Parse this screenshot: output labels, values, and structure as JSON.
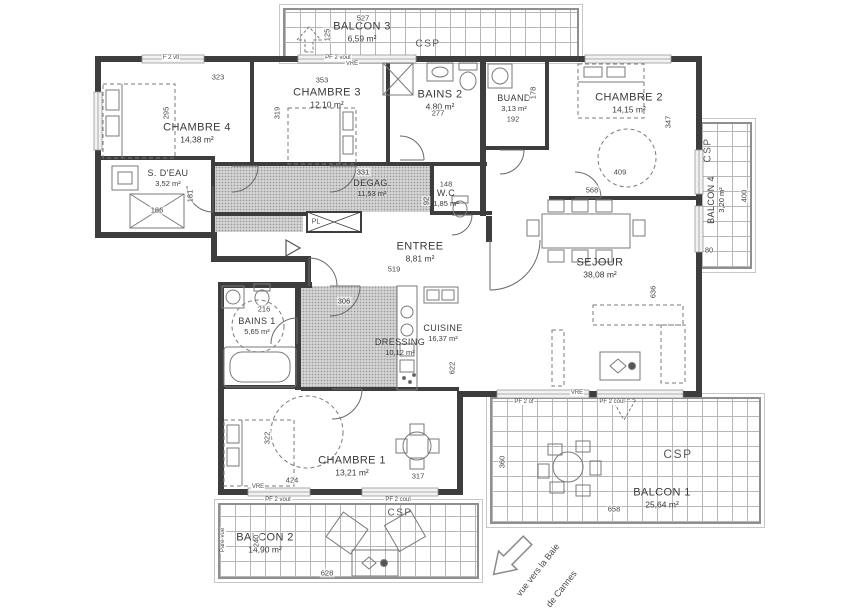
{
  "rooms": [
    {
      "name": "CHAMBRE 4",
      "area": "14,38 m²"
    },
    {
      "name": "CHAMBRE 3",
      "area": "12,10 m²"
    },
    {
      "name": "BAINS 2",
      "area": "4,80 m²"
    },
    {
      "name": "BUAND",
      "area": "3,13 m²"
    },
    {
      "name": "CHAMBRE 2",
      "area": "14,15 m²"
    },
    {
      "name": "S. D'EAU",
      "area": "3,52 m²"
    },
    {
      "name": "DEGAG.",
      "area": "11,53 m²"
    },
    {
      "name": "W.C",
      "area": "1,85 m²"
    },
    {
      "name": "ENTREE",
      "area": "8,81 m²"
    },
    {
      "name": "SEJOUR",
      "area": "38,08 m²"
    },
    {
      "name": "BAINS 1",
      "area": "5,65 m²"
    },
    {
      "name": "DRESSING",
      "area": "10,12 m²"
    },
    {
      "name": "CUISINE",
      "area": "16,37 m²"
    },
    {
      "name": "CHAMBRE 1",
      "area": "13,21 m²"
    },
    {
      "name": "BALCON 1",
      "area": "25,64 m²"
    },
    {
      "name": "BALCON 2",
      "area": "14,90 m²"
    },
    {
      "name": "BALCON 3",
      "area": "6,59 m²"
    },
    {
      "name": "BALCON 4",
      "area": "3,20 m²"
    }
  ],
  "dims": {
    "d527": "527",
    "d125": "125",
    "d323": "323",
    "d353": "353",
    "d295": "295",
    "d319": "319",
    "d277": "277",
    "d192": "192",
    "d178": "178",
    "d409": "409",
    "d347": "347",
    "d568": "568",
    "d186": "186",
    "d181": "181",
    "d331": "331",
    "d148": "148",
    "d92": "92",
    "d519": "519",
    "d636": "636",
    "d400": "400",
    "d80": "80",
    "d216": "216",
    "d306": "306",
    "d622": "622",
    "d322": "322",
    "d424": "424",
    "d317": "317",
    "d658": "658",
    "d360": "360",
    "d240": "240",
    "d628": "628"
  },
  "tags": {
    "csp": "CSP",
    "pl": "PL",
    "vre": "VRE",
    "pare_vue": "Pare-vue",
    "pf2_vout": "PF 2 vout",
    "pf2_coul": "PF 2 coul",
    "pf2_of": "PF 2 of",
    "f2_vtl": "F 2 vtl"
  },
  "view": {
    "line1": "vue vers la Baie",
    "line2": "de Cannes"
  },
  "colors": {
    "wall": "#3d3d3d",
    "hatch_fill": "#d4d4d4",
    "hatch_dot": "#9b9b9b",
    "balcony_grid": "#b6b6b6",
    "text": "#3a3a3a"
  }
}
